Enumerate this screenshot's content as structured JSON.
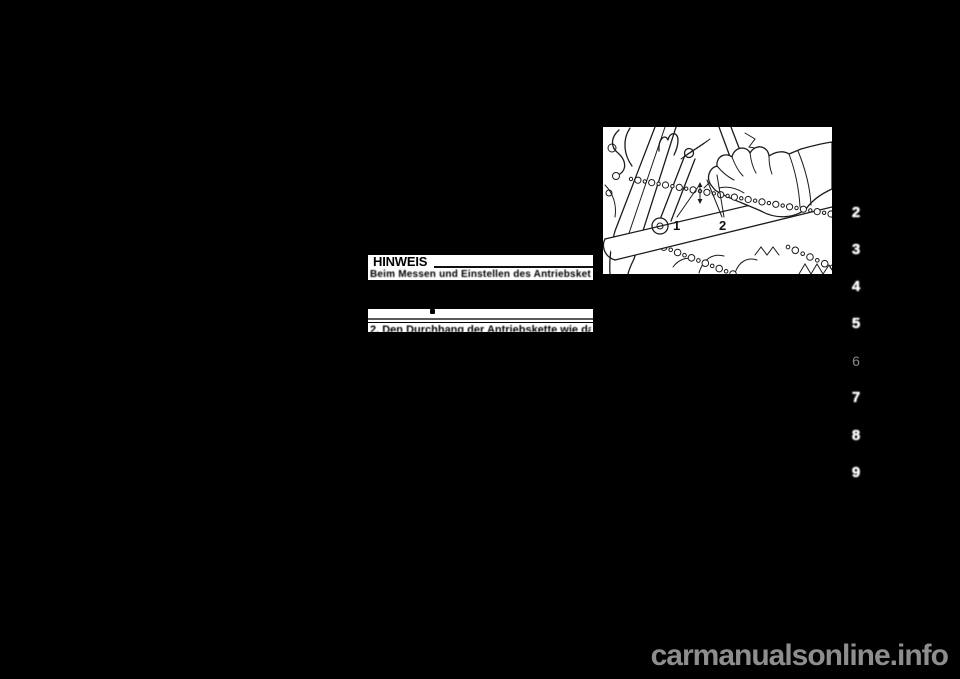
{
  "page": {
    "background_color": "#000000"
  },
  "note_box": {
    "title": "HINWEIS",
    "degraded_line": "Beim Messen und Einstellen des Antriebsket-",
    "clipped_step_line": "2. Den Durchhang der Antriebskette wie dar-"
  },
  "figure": {
    "description": "Hand pressing motorcycle drive chain to check slack",
    "callout_1": "1",
    "callout_2": "2"
  },
  "chapter_tabs": {
    "items": [
      {
        "number": "2"
      },
      {
        "number": "3"
      },
      {
        "number": "4"
      },
      {
        "number": "5"
      },
      {
        "number": "6"
      },
      {
        "number": "7"
      },
      {
        "number": "8"
      },
      {
        "number": "9"
      }
    ],
    "number_color": "#ffffff",
    "muted_color": "#8a8a8a"
  },
  "watermark": {
    "text": "carmanualsonline.info",
    "color": "#8e8e8e"
  }
}
